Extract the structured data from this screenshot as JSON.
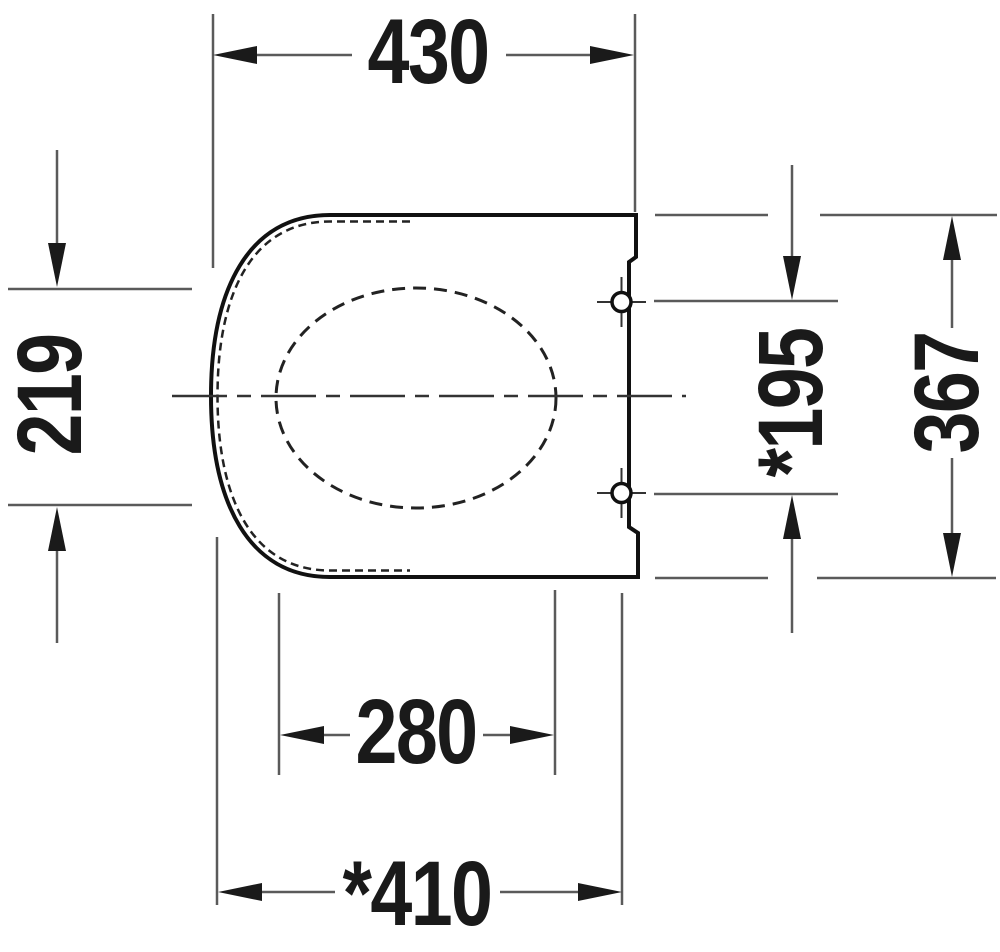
{
  "page": {
    "background": "#ffffff"
  },
  "drawing": {
    "type": "technical-dimension-drawing",
    "subject": "toilet-seat-top-view",
    "colors": {
      "outline": "#111111",
      "dashed_line": "#222222",
      "dimension_line": "#5a5a5a",
      "arrow": "#1a1a1a",
      "text": "#1a1a1a"
    },
    "labels": {
      "top_width": "430",
      "left_depth": "219",
      "hinge_spacing": "*195",
      "right_depth": "367",
      "opening_width": "280",
      "bottom_width": "*410"
    }
  }
}
